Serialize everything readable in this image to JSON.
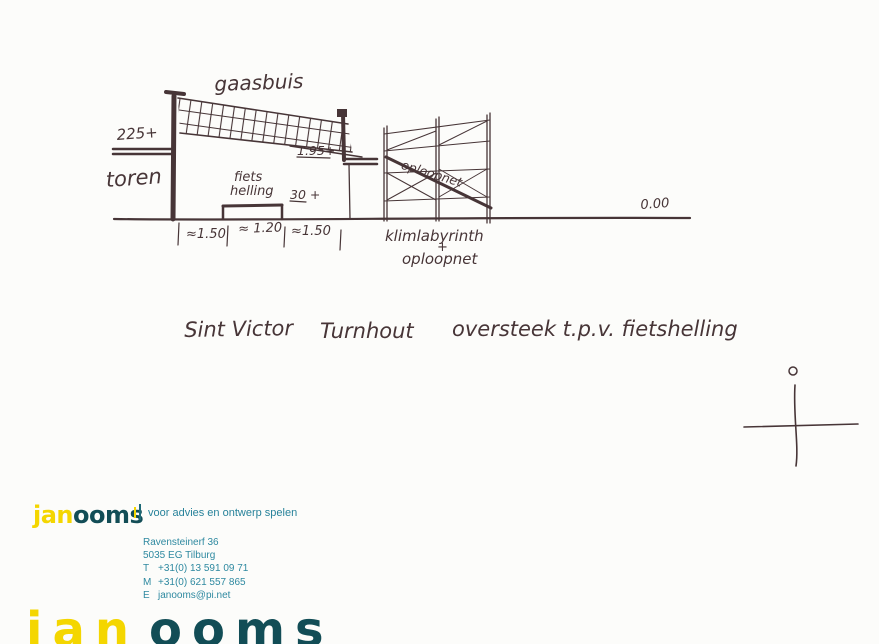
{
  "sketch": {
    "ink_color": "#473537",
    "net_label": "gaasbuis",
    "tower_height": "225+",
    "tower_label": "toren",
    "ramp_label_line1": "fiets",
    "ramp_label_line2": "helling",
    "deck_height": "1.95+",
    "ramp_height": "30 +",
    "net_diagonal_label": "oploopnet",
    "ground_level": "0.00",
    "dim_left": "≈1.50",
    "dim_mid": "≈ 1.20",
    "dim_right": "≈1.50",
    "scaffold_label_line1": "klimlabyrinth",
    "scaffold_label_plus": "+",
    "scaffold_label_line2": "oploopnet"
  },
  "caption": {
    "project": "Sint Victor",
    "city": "Turnhout",
    "description": "oversteek t.p.v. fietshelling"
  },
  "footer": {
    "logo_part1": "jan",
    "logo_part2": "ooms",
    "tagline": "voor advies en ontwerp spelen",
    "address_line1": "Ravensteinerf 36",
    "address_line2": "5035 EG Tilburg",
    "phone_label": "T",
    "phone": "+31(0) 13 591 09 71",
    "mobile_label": "M",
    "mobile": "+31(0) 621 557 865",
    "email_label": "E",
    "email": "janooms@pi.net",
    "brand_yellow": "#f4d600",
    "brand_teal_dark": "#124d56",
    "brand_teal": "#2e89a0"
  },
  "watermark": {
    "part1": "jan",
    "part2": "ooms"
  }
}
